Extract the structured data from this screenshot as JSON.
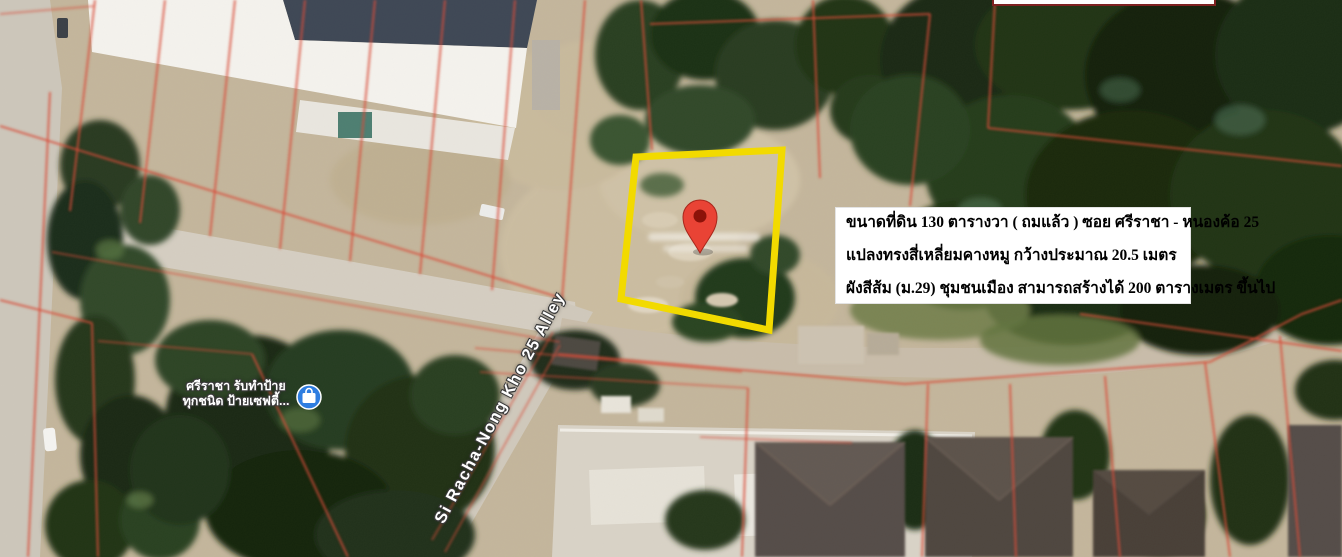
{
  "map": {
    "type": "satellite-view-with-cadastral-overlay",
    "street_label": "Si Racha-Nong Kho 25 Alley",
    "poi": {
      "name_line1": "ศรีราชา รับทำป้าย",
      "name_line2": "ทุกชนิด ป้ายเซฟตี้...",
      "icon": "blue-business-marker"
    },
    "pin_icon": "red-location-pin",
    "plot_highlight": "yellow-rectangle-outline"
  },
  "info_box": {
    "line1": "ขนาดที่ดิน 130 ตารางวา ( ถมแล้ว ) ซอย ศรีราชา - หนองค้อ 25",
    "line2": "แปลงทรงสี่เหลี่ยมคางหมู กว้างประมาณ 20.5 เมตร",
    "line3": "ผังสีส้ม (ม.29) ชุมชนเมือง สามารถสร้างได้ 200 ตารางเมตร ขึ้นไป"
  },
  "colors": {
    "plot_outline": "#f2da00",
    "parcel_line": "#d94b38",
    "pin_red": "#e94335",
    "pin_core": "#8c1209",
    "poi_blue": "#2e7de0",
    "ground": "#c4b69c",
    "road": "#d3ccc0",
    "info_box_bg": "#ffffff",
    "info_text": "#000000",
    "label_text": "#ffffff"
  }
}
